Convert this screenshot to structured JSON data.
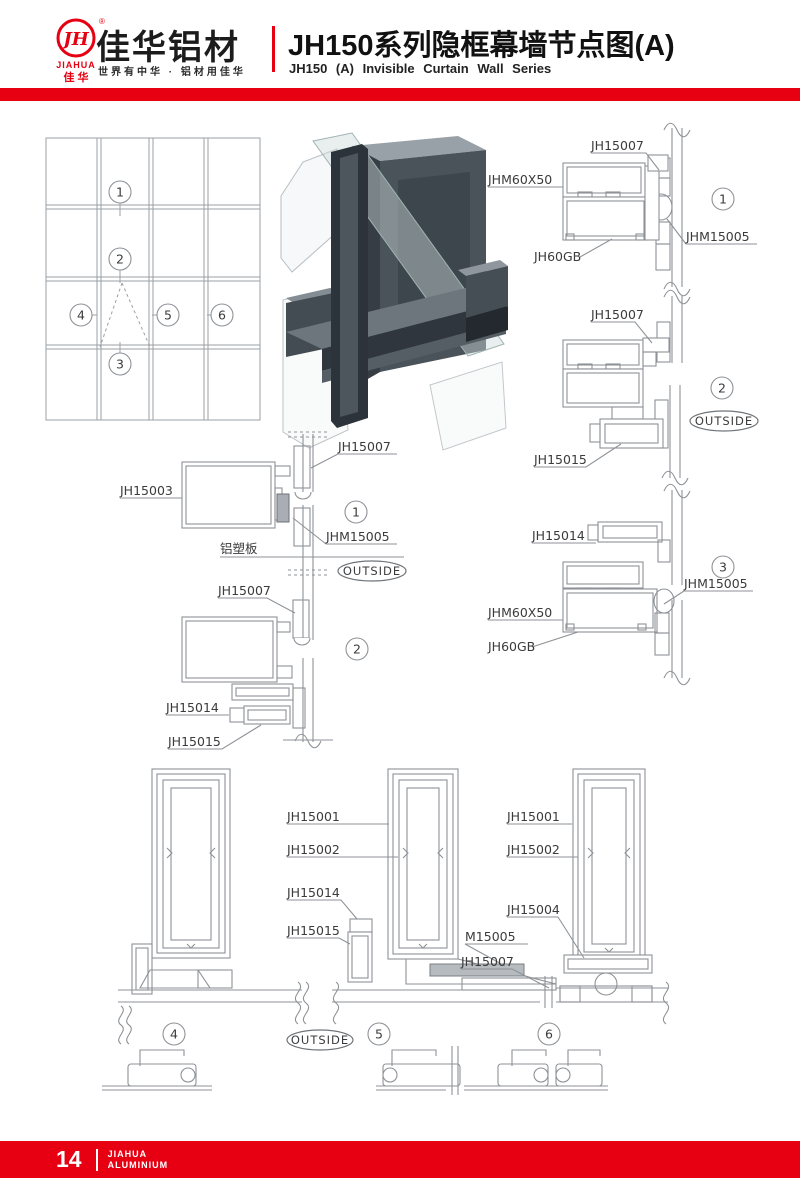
{
  "colors": {
    "accent_red": "#e60012",
    "line_gray": "#8e9297",
    "label_gray": "#3b3b3b"
  },
  "header": {
    "logo_monogram": "JH",
    "logo_reg": "®",
    "logo_text_en": "JIAHUA",
    "logo_text_cn": "佳 华",
    "company_name": "佳华铝材",
    "tagline": "世界有中华 · 铝材用佳华",
    "title_cn": "JH150系列隐框幕墙节点图(A)",
    "title_en": "JH150 (A) Invisible Curtain Wall Series"
  },
  "callouts": {
    "n1": "1",
    "n2": "2",
    "n3": "3",
    "n4": "4",
    "n5": "5",
    "n6": "6"
  },
  "labels": {
    "jh15001": "JH15001",
    "jh15002": "JH15002",
    "jh15003": "JH15003",
    "jh15004": "JH15004",
    "jh15007": "JH15007",
    "jh15014": "JH15014",
    "jh15015": "JH15015",
    "jhm60x50": "JHM60X50",
    "jh60gb": "JH60GB",
    "jhm15005": "JHM15005",
    "m15005": "M15005",
    "acp": "铝塑板",
    "outside": "OUTSIDE"
  },
  "footer": {
    "page_number": "14",
    "brand_top": "JIAHUA",
    "brand_bottom": "ALUMINIUM"
  }
}
